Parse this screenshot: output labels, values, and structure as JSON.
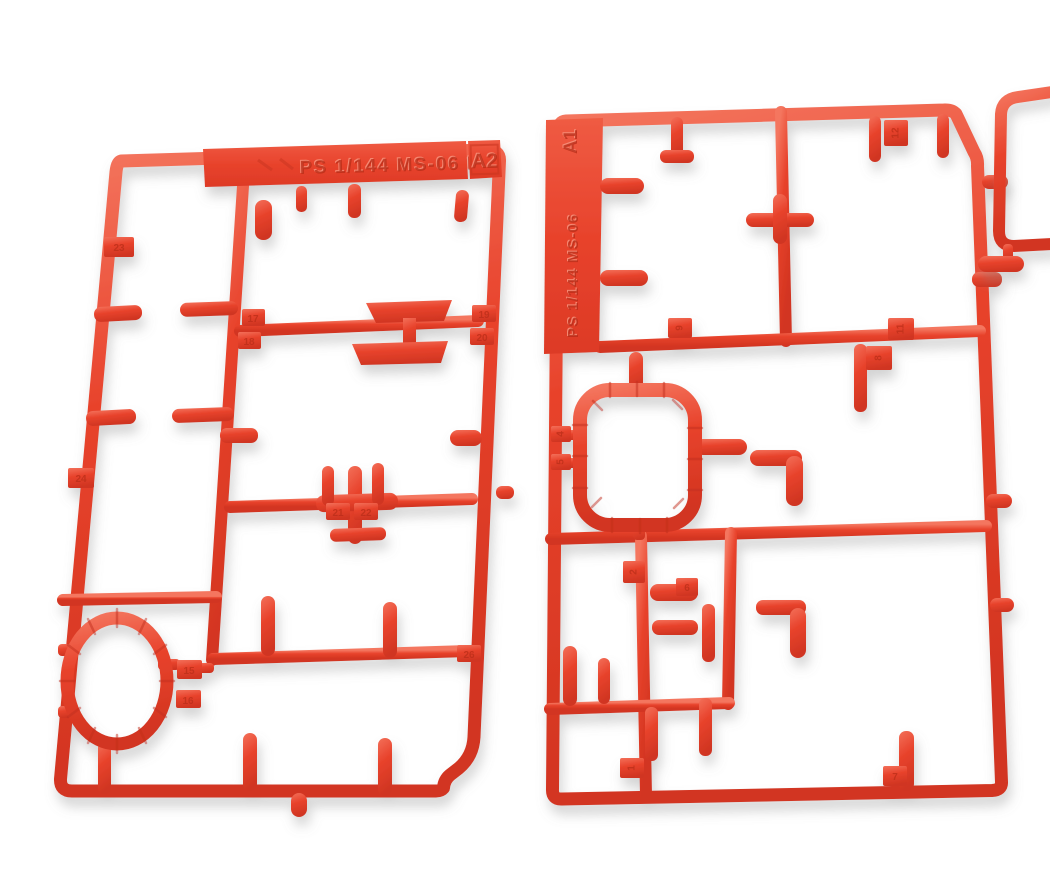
{
  "scene": {
    "description": "Photo of two red plastic model-kit sprues (part runners) with numbered part tabs on a white background, corner of a third sprue at top right",
    "background_color": "#ffffff",
    "colors": {
      "plastic_base": "#e8432c",
      "plastic_highlight": "#f4765f",
      "plastic_shadow": "#c93220",
      "embossed_text": "#b92c18",
      "cast_shadow": "#8a8a8a"
    }
  },
  "sprues": {
    "left": {
      "code": "A2",
      "marking": "PS 1/144 MS-06 F2",
      "tabs": {
        "left_rail_upper": "23",
        "left_rail_lower": "24",
        "mid_rail_left_top": "17",
        "mid_rail_left_bottom": "18",
        "mid_rail_right_top": "19",
        "mid_rail_right_bottom": "20",
        "lower_rail_a": "21",
        "lower_rail_b": "22",
        "ring_top": "15",
        "ring_bottom": "16",
        "lower_right": "26"
      }
    },
    "right": {
      "code": "A1",
      "marking": "PS 1/144 MS-06",
      "tabs": {
        "top_rail": "12",
        "mid_rail_upper": "11",
        "mid_rail_lower": "8",
        "mid_rail_left": "9",
        "ring_left_a": "4",
        "ring_left_b": "5",
        "lower_col_upper": "2",
        "lower_mid": "6",
        "lower_col_bottom": "1",
        "bottom_rail": "7"
      }
    }
  }
}
